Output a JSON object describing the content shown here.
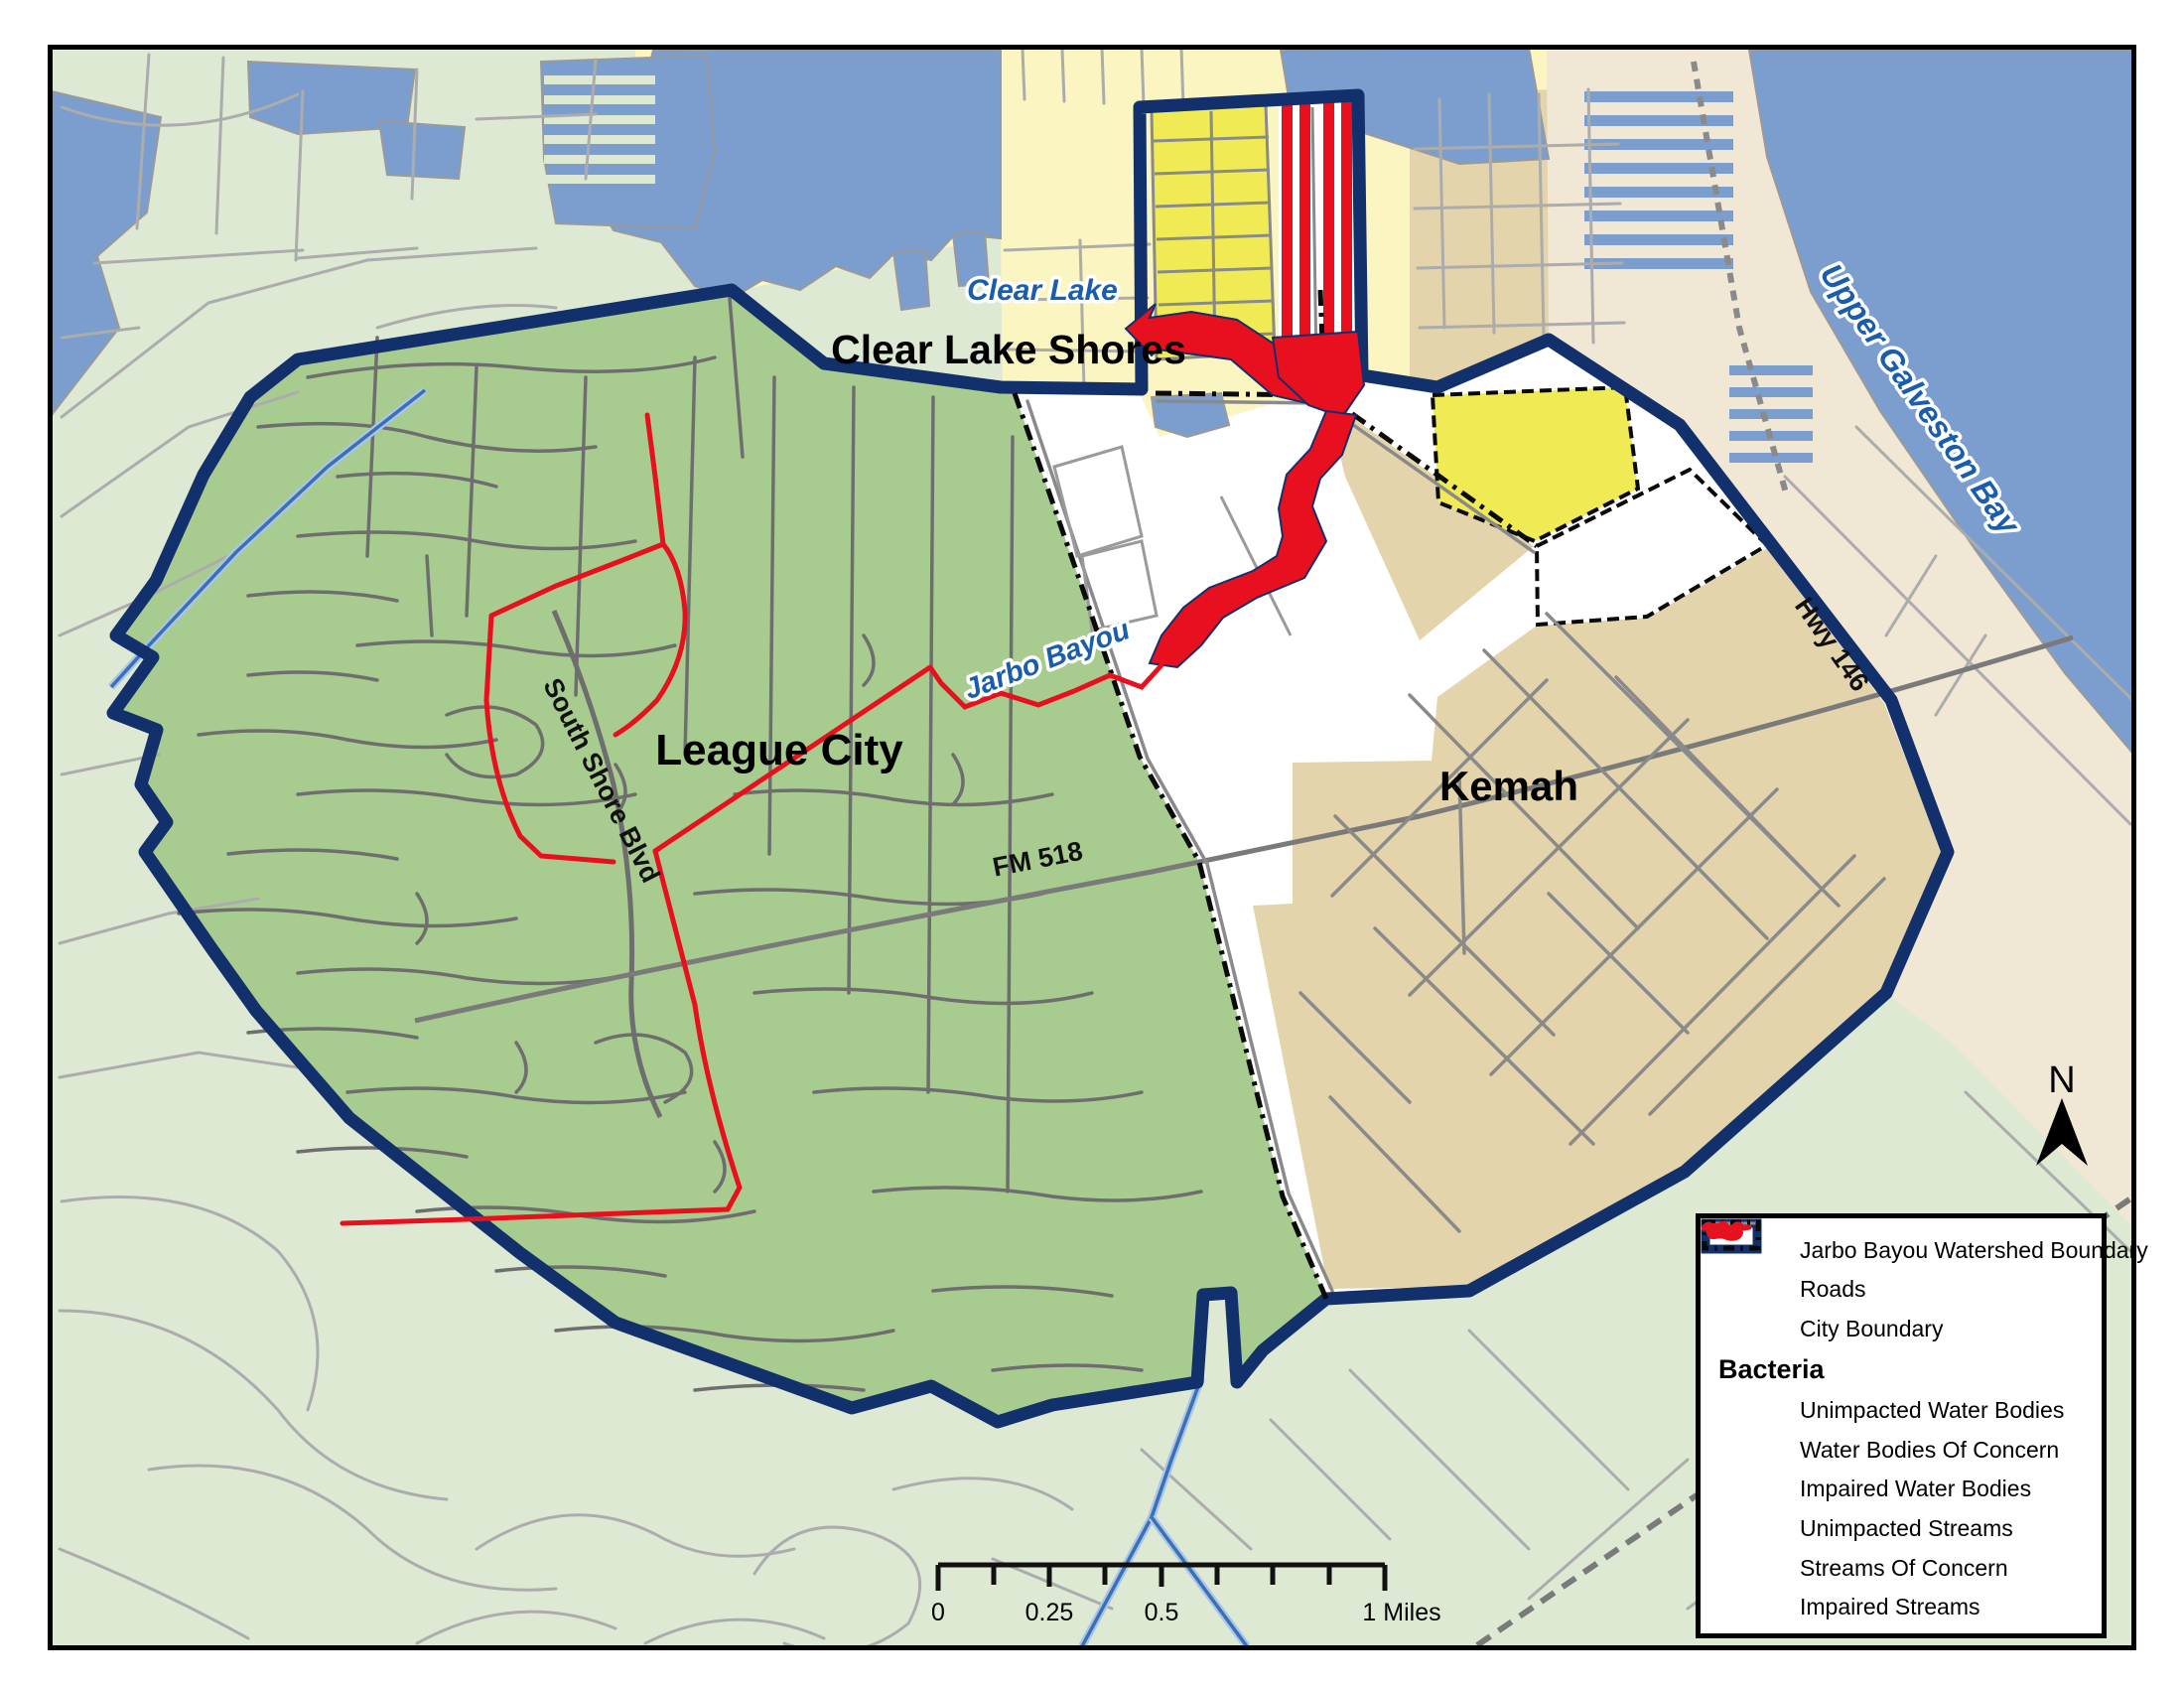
{
  "map": {
    "labels": {
      "clear_lake": "Clear Lake",
      "clear_lake_shores": "Clear Lake Shores",
      "league_city": "League City",
      "kemah": "Kemah",
      "jarbo_bayou": "Jarbo Bayou",
      "south_shore_blvd": "South Shore Blvd",
      "fm_518": "FM 518",
      "hwy_146": "Hwy 146",
      "upper_galveston_bay": "Upper Galveston Bay"
    },
    "north_arrow": {
      "label": "N"
    },
    "scale": {
      "t0": "0",
      "t025": "0.25",
      "t05": "0.5",
      "t1": "1 Miles"
    }
  },
  "legend": {
    "section_header": "Bacteria",
    "items": [
      {
        "label": "Jarbo Bayou Watershed Boundary",
        "swatch": "watershed"
      },
      {
        "label": "Roads",
        "swatch": "road"
      },
      {
        "label": "City Boundary",
        "swatch": "cityboundary"
      },
      {
        "label": "Unimpacted Water Bodies",
        "swatch": "blob-blue"
      },
      {
        "label": "Water Bodies Of Concern",
        "swatch": "blob-orange"
      },
      {
        "label": "Impaired Water Bodies",
        "swatch": "blob-red"
      },
      {
        "label": "Unimpacted Streams",
        "swatch": "squig-blue"
      },
      {
        "label": "Streams Of Concern",
        "swatch": "squig-orange"
      },
      {
        "label": "Impaired Streams",
        "swatch": "squig-red"
      }
    ]
  },
  "colors": {
    "navy": "#12306B",
    "red": "#E8101E",
    "orange": "#E8A01D",
    "stream_blue": "#1A5DAD",
    "water": "#7B9ECF",
    "pale_green": "#DEE9D4",
    "watershed_green": "#A8CC90",
    "kemah_tan": "#E4D4AB",
    "bright_yellow": "#F0EB55",
    "pale_yellow": "#FAF5C1",
    "bay_land": "#F0E7D5",
    "road_gray": "#8A8A8A"
  }
}
